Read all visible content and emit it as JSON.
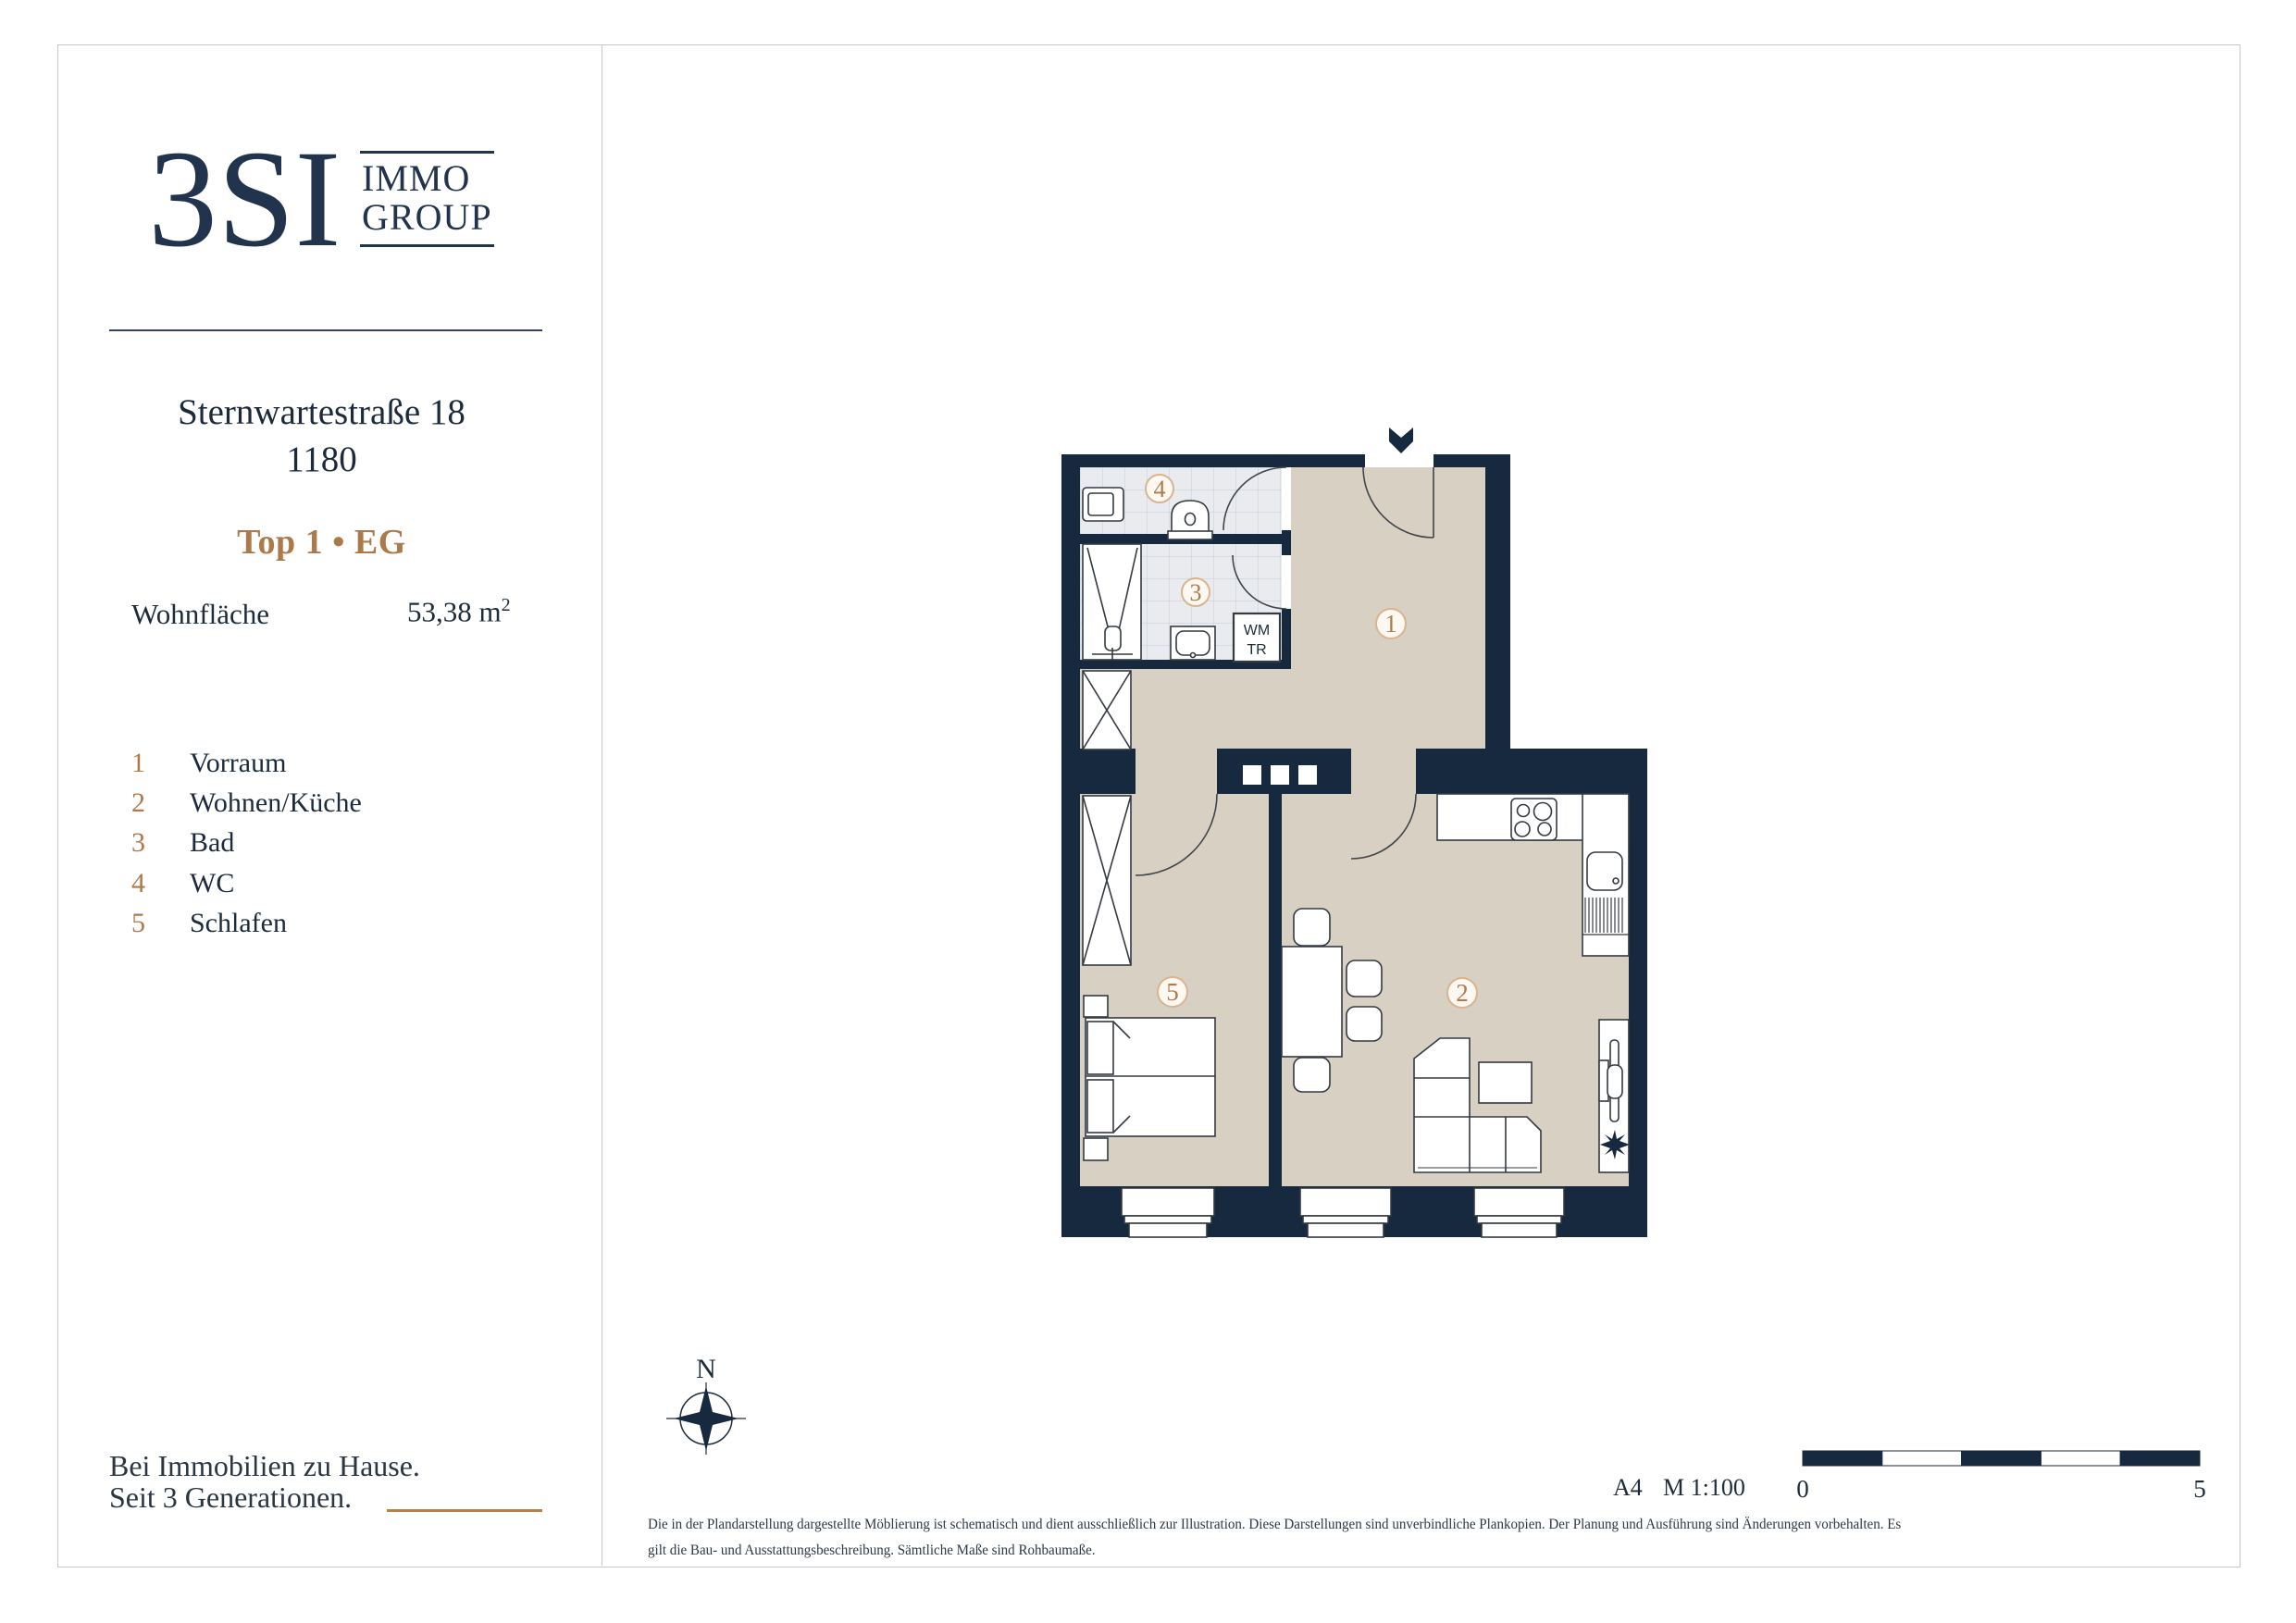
{
  "sidebar": {
    "logo": {
      "mark": "3SI",
      "immo_line1": "IMMO",
      "immo_line2": "GROUP"
    },
    "address_line1": "Sternwartestraße 18",
    "address_line2": "1180",
    "unit_label": "Top 1 • EG",
    "area_label": "Wohnfläche",
    "area_value": "53,38 m",
    "area_sup": "2",
    "footer_line1": "Bei Immobilien zu Hause.",
    "footer_line2": "Seit 3 Generationen."
  },
  "rooms": [
    {
      "num": "1",
      "label": "Vorraum"
    },
    {
      "num": "2",
      "label": "Wohnen/Küche"
    },
    {
      "num": "3",
      "label": "Bad"
    },
    {
      "num": "4",
      "label": "WC"
    },
    {
      "num": "5",
      "label": "Schlafen"
    }
  ],
  "plan": {
    "labels": {
      "wm": "WM",
      "tr": "TR",
      "compass": "N"
    },
    "scale": {
      "sheet": "A4",
      "ratio": "M 1:100",
      "start": "0",
      "end": "5"
    }
  },
  "disclaimer": {
    "line1": "Die in der Plandarstellung dargestellte Möblierung ist schematisch und dient ausschließlich zur Illustration. Diese Darstellungen sind unverbindliche Plankopien. Der Planung und Ausführung sind Änderungen vorbehalten. Es",
    "line2": "gilt die Bau- und Ausstattungsbeschreibung. Sämtliche Maße sind Rohbaumaße."
  },
  "colors": {
    "wall_navy": "#17293e",
    "logo_navy": "#22334e",
    "bronze": "#b0794a",
    "circle_stroke": "#d9b48e",
    "floor_beige": "#d8d0c2",
    "tile": "#e9ebee",
    "border_gray": "#c2c6cc"
  }
}
